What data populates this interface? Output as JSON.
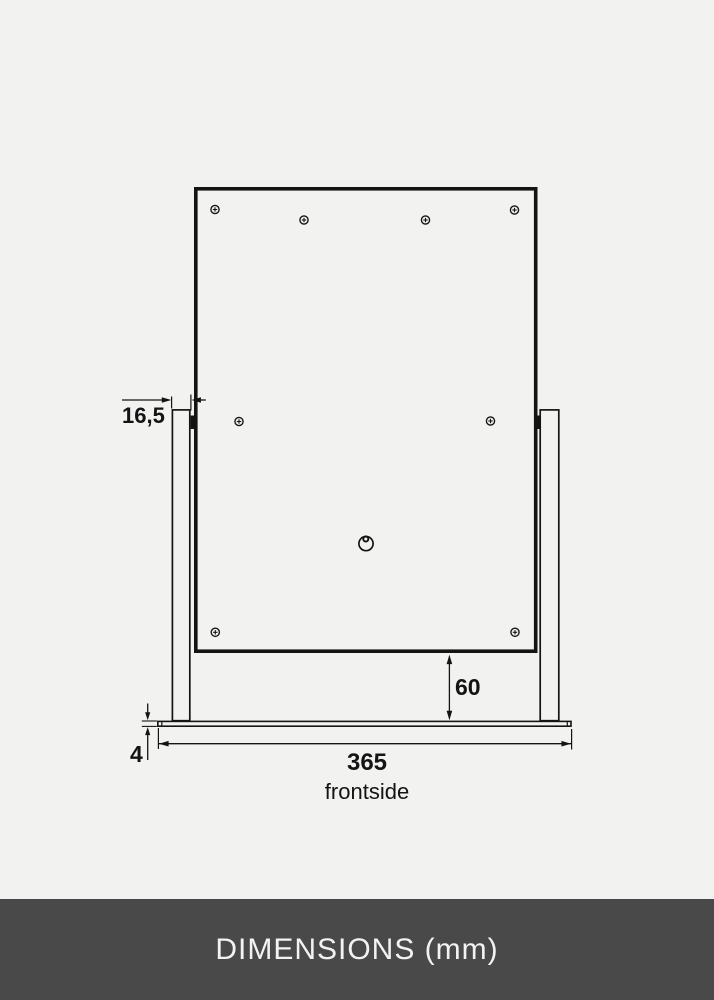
{
  "drawing": {
    "view_label": "frontside",
    "dimensions": {
      "post_width_mm": "16,5",
      "panel_bottom_to_base_mm": "60",
      "base_plate_thickness_mm": "4",
      "base_plate_width_mm": "365"
    }
  },
  "footer": {
    "title": "DIMENSIONS (mm)"
  },
  "colors": {
    "background": "#f2f2f1",
    "line": "#141414",
    "footer_bg": "#494949",
    "footer_text": "#f2f2f2"
  }
}
